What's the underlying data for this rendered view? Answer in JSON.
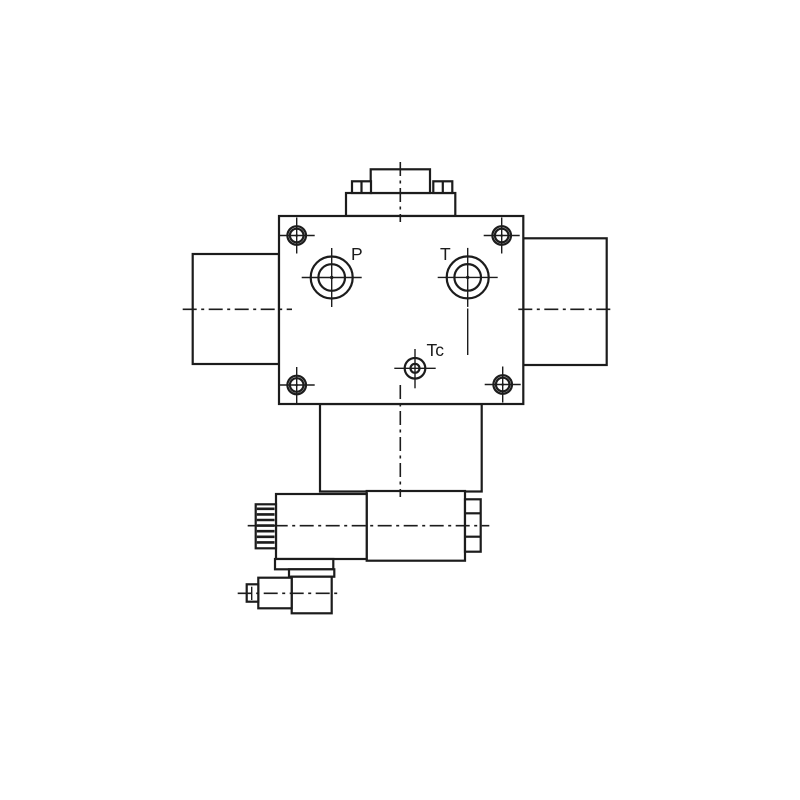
{
  "theme": {
    "bg": "#ffffff",
    "line": "#1c1c1c"
  },
  "drawing": {
    "ports": {
      "p": "P",
      "t": "T",
      "tc": "Tc"
    }
  }
}
